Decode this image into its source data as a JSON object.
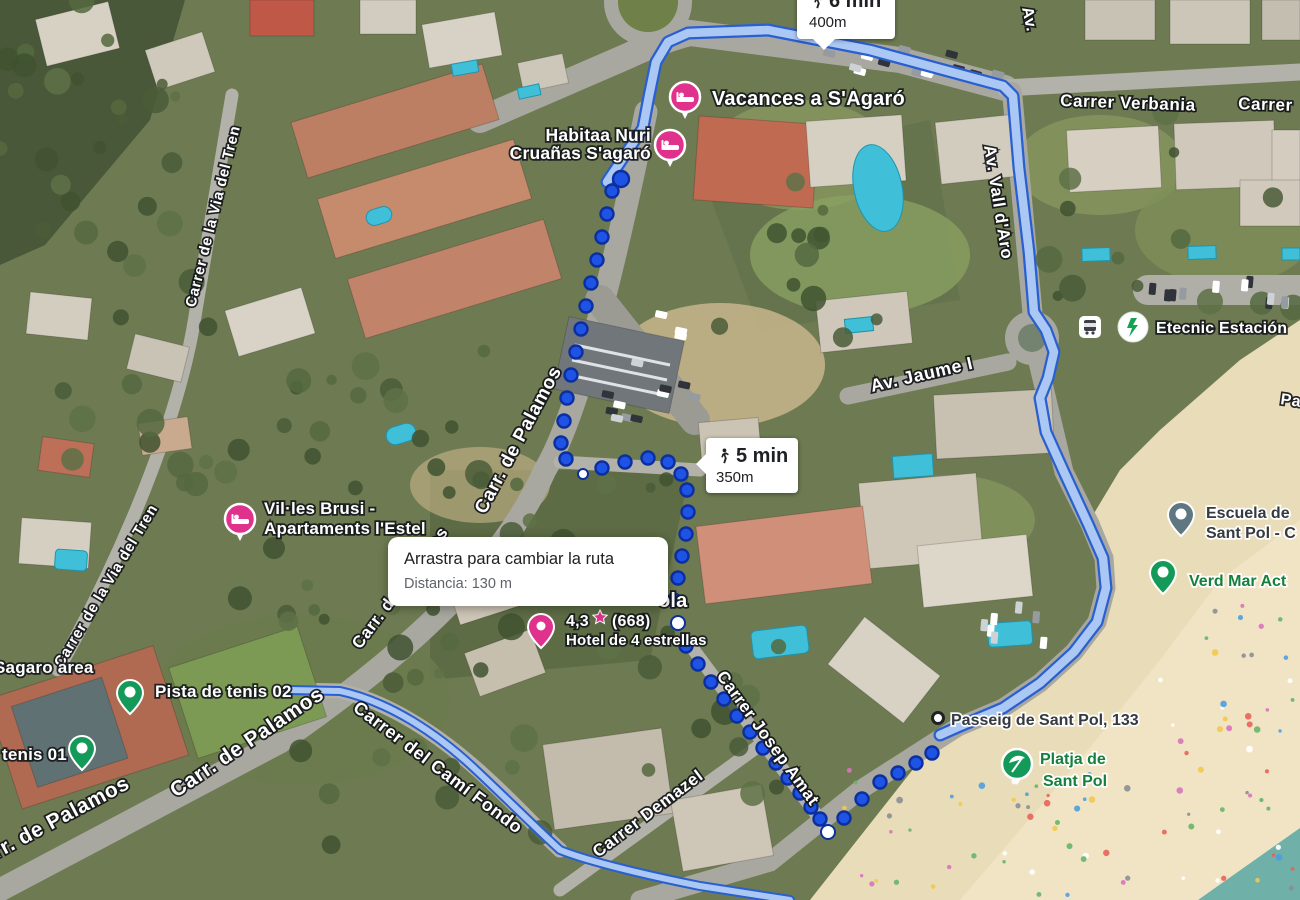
{
  "app": "map-route-view",
  "tooltips": {
    "route_top": {
      "duration": "6 min",
      "distance": "400m"
    },
    "route_mid": {
      "duration": "5 min",
      "distance": "350m"
    },
    "drag_hint": {
      "title": "Arrastra para cambiar la ruta",
      "distance_label": "Distancia: 130 m"
    }
  },
  "streets": {
    "verbania": "Carrer Verbania",
    "carrer_cut": "Carrer",
    "vall_daro": "Av. Vall d'Aro",
    "av_cut": "Av.",
    "jaume": "Av. Jaume I",
    "via_tren_1": "Carrer de la Via del Tren",
    "via_tren_2": "Carrer de la Via del Tren",
    "palamos_route": "Carr. de Palamos",
    "palamos_big": "Carr. de Palamos",
    "palamos_edge": "Carr. de Palamos",
    "palamos_small": "Carr. de Palamos",
    "cami_fondo": "Carrer del Camí Fondo",
    "demazel": "Carrer Demazel",
    "josep_amat": "Carrer Josep Amat",
    "pa_cut": "Pa"
  },
  "pois": {
    "vacances": {
      "label": "Vacances a S'Agaró"
    },
    "habitaa": {
      "line1": "Habitaa Nuri",
      "line2": "Cruañas S'agaró"
    },
    "villes": {
      "line1": "Vil·les Brusi -",
      "line2": "Apartaments l'Estel"
    },
    "hotel": {
      "name_fragment": "ola",
      "rating": "4,3",
      "reviews": "(668)",
      "category": "Hotel de 4 estrellas"
    },
    "pista02": {
      "label": "Pista de tenis 02"
    },
    "tenis01": {
      "label": "tenis 01"
    },
    "sagaro_area": {
      "label": "Sagaro area"
    },
    "escuela": {
      "line1": "Escuela de",
      "line2": "Sant Pol - C"
    },
    "verd_mar": {
      "label": "Verd Mar Act"
    },
    "platja": {
      "line1": "Platja de",
      "line2": "Sant Pol"
    },
    "etecnic": {
      "label": "Etecnic Estación"
    },
    "passeig133": {
      "label": "Passeig de Sant Pol, 133"
    }
  },
  "colors": {
    "route_casing": "#2a5fd0",
    "route_fill": "#abc8f4",
    "route_dot": "#1f53e5",
    "route_dot_ring": "#0c2f9e",
    "lodging_pink": "#e0318c",
    "poi_green": "#149a58",
    "poi_slate": "#5f7780",
    "sand": "#e9dcb9",
    "beach": "#f0e4c4",
    "water": "#6fb0a8",
    "road": "#a8a8a0"
  }
}
